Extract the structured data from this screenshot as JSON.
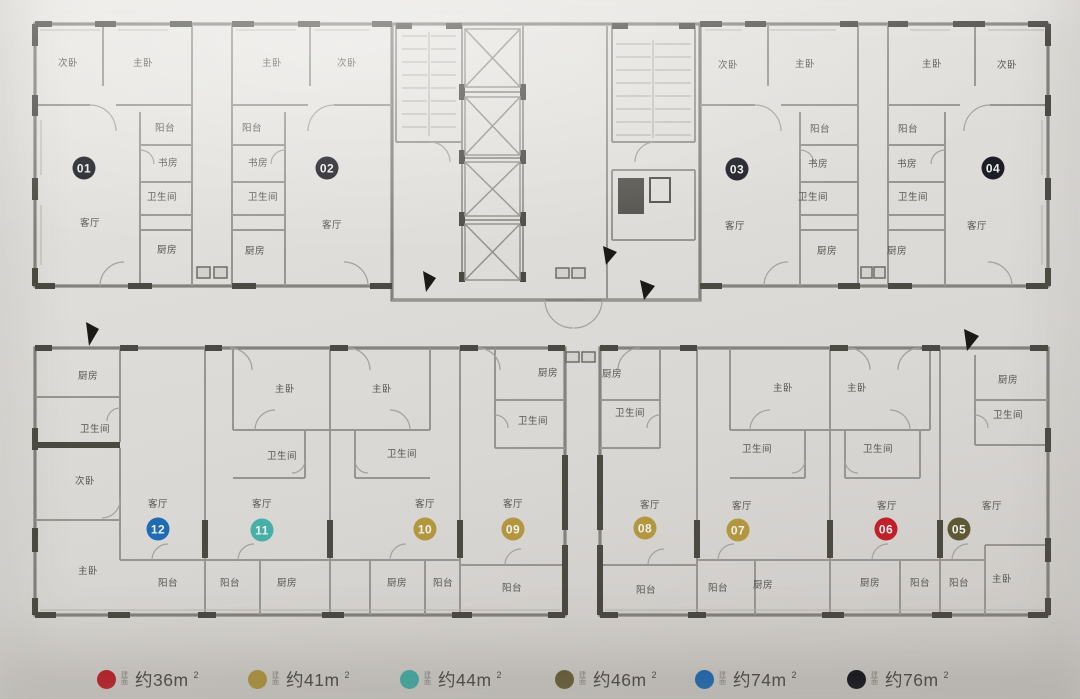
{
  "units": [
    {
      "number": "01",
      "color": "#1d1d25",
      "rooms": [
        "次卧",
        "主卧",
        "阳台",
        "书房",
        "卫生间",
        "客厅",
        "厨房"
      ]
    },
    {
      "number": "02",
      "color": "#1d1d25",
      "rooms": [
        "主卧",
        "次卧",
        "阳台",
        "书房",
        "卫生间",
        "客厅",
        "厨房"
      ]
    },
    {
      "number": "03",
      "color": "#1d1d25",
      "rooms": [
        "次卧",
        "主卧",
        "阳台",
        "书房",
        "卫生间",
        "客厅",
        "厨房"
      ]
    },
    {
      "number": "04",
      "color": "#1d1d25",
      "rooms": [
        "主卧",
        "次卧",
        "阳台",
        "书房",
        "卫生间",
        "客厅",
        "厨房"
      ]
    },
    {
      "number": "05",
      "color": "#5e5834",
      "rooms": [
        "厨房",
        "卫生间",
        "客厅",
        "阳台",
        "主卧"
      ]
    },
    {
      "number": "06",
      "color": "#c1202a",
      "rooms": [
        "主卧",
        "卫生间",
        "客厅",
        "厨房",
        "阳台"
      ]
    },
    {
      "number": "07",
      "color": "#b3973f",
      "rooms": [
        "主卧",
        "卫生间",
        "客厅",
        "阳台",
        "厨房"
      ]
    },
    {
      "number": "08",
      "color": "#b3973f",
      "rooms": [
        "厨房",
        "卫生间",
        "客厅",
        "阳台"
      ]
    },
    {
      "number": "09",
      "color": "#b3973f",
      "rooms": [
        "厨房",
        "卫生间",
        "客厅",
        "阳台"
      ]
    },
    {
      "number": "10",
      "color": "#b3973f",
      "rooms": [
        "主卧",
        "卫生间",
        "客厅",
        "厨房",
        "阳台"
      ]
    },
    {
      "number": "11",
      "color": "#45b0a8",
      "rooms": [
        "主卧",
        "卫生间",
        "客厅",
        "阳台",
        "厨房"
      ]
    },
    {
      "number": "12",
      "color": "#1f6cb5",
      "rooms": [
        "厨房",
        "卫生间",
        "次卧",
        "主卧",
        "客厅",
        "阳台"
      ]
    }
  ],
  "legend": {
    "items": [
      {
        "prefix": "建面",
        "area": "约36m",
        "sup": "2",
        "color": "#c1202a"
      },
      {
        "prefix": "建面",
        "area": "约41m",
        "sup": "2",
        "color": "#b3973f"
      },
      {
        "prefix": "建面",
        "area": "约44m",
        "sup": "2",
        "color": "#45b0a8"
      },
      {
        "prefix": "建面",
        "area": "约46m",
        "sup": "2",
        "color": "#6a6239"
      },
      {
        "prefix": "建面",
        "area": "约74m",
        "sup": "2",
        "color": "#1f6cb5"
      },
      {
        "prefix": "建面",
        "area": "约76m",
        "sup": "2",
        "color": "#15151d"
      }
    ]
  }
}
